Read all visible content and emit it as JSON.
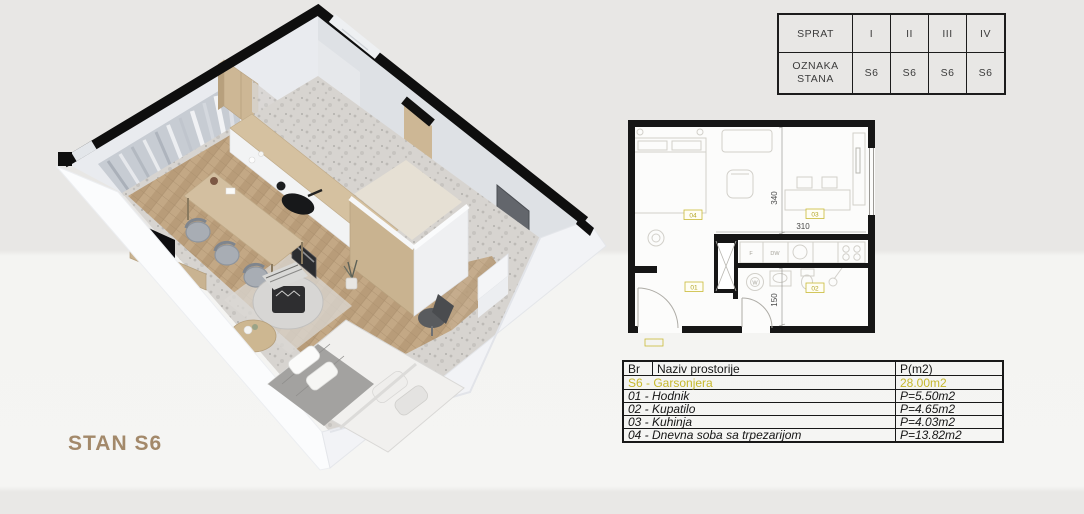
{
  "render": {
    "title": "STAN S6",
    "tv_label": "NETFLIX"
  },
  "floor_table": {
    "floor_label": "SPRAT",
    "unit_label_line1": "OZNAKA",
    "unit_label_line2": "STANA",
    "floors": [
      "I",
      "II",
      "III",
      "IV"
    ],
    "units": [
      "S6",
      "S6",
      "S6",
      "S6"
    ]
  },
  "floorplan": {
    "dim_main_height": "340",
    "dim_kitchen_width": "310",
    "dim_bath_height": "150",
    "room_labels": {
      "living": "04",
      "kitchen": "03",
      "hall": "01",
      "bath": "02"
    },
    "appliance_labels": {
      "fridge": "F",
      "dishwasher": "DW",
      "washer": "W"
    }
  },
  "room_table": {
    "header": {
      "br": "Br",
      "name": "Naziv prostorije",
      "area": "P(m2)"
    },
    "summary": {
      "name": "S6 - Garsonjera",
      "area": "28.00m2"
    },
    "rows": [
      {
        "name": "01 - Hodnik",
        "area": "P=5.50m2"
      },
      {
        "name": "02 - Kupatilo",
        "area": "P=4.65m2"
      },
      {
        "name": "03 - Kuhinja",
        "area": "P=4.03m2"
      },
      {
        "name": "04 - Dnevna soba sa trpezarijom",
        "area": "P=13.82m2"
      }
    ]
  },
  "colors": {
    "accent_yellow": "#c9ba35",
    "wall_black": "#121212",
    "title_brown": "#a3896a",
    "netflix_red": "#e02b20"
  }
}
